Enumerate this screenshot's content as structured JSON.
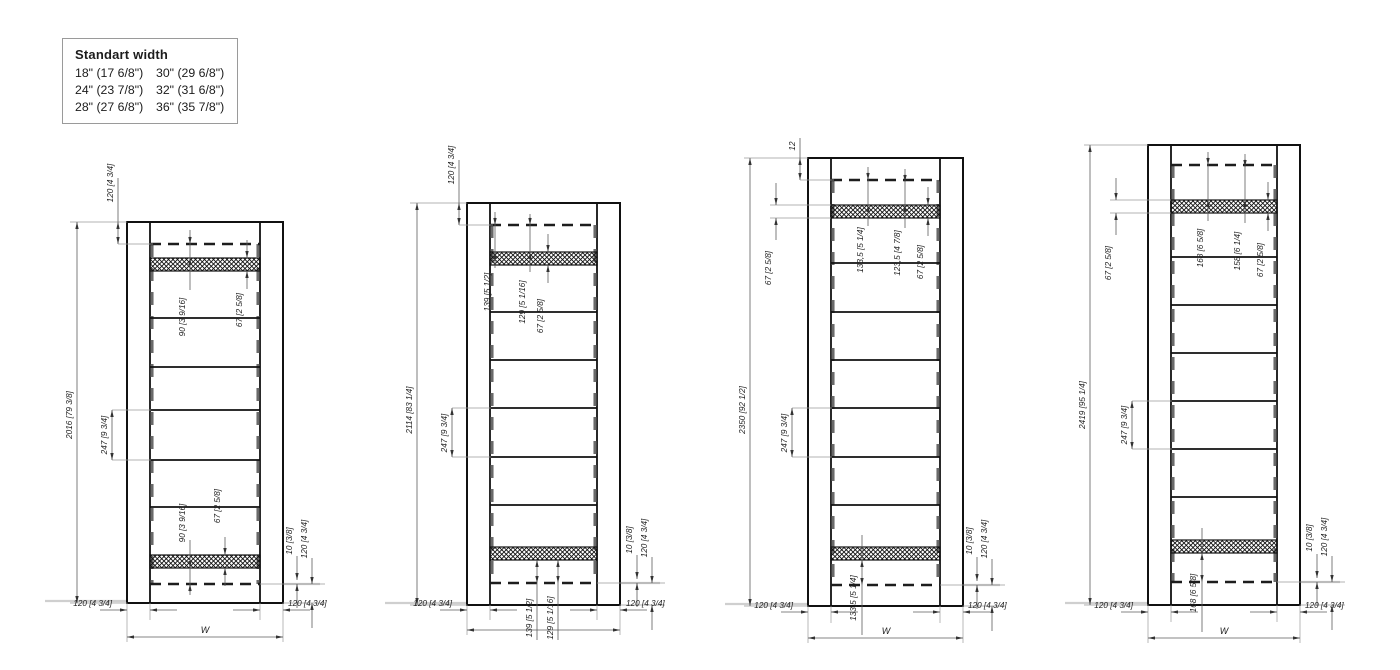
{
  "legend": {
    "title": "Standart width",
    "col1": [
      "18\" (17 6/8\")",
      "24\" (23 7/8\")",
      "28\" (27 6/8\")"
    ],
    "col2": [
      "30\" (29 6/8\")",
      "32\" (31 6/8\")",
      "36\" (35 7/8\")"
    ]
  },
  "doors": [
    {
      "height": "2016 [79 3/8]",
      "top": "120 [4 3/4]",
      "gap": "247 [9 3/4]",
      "it_a": "90 [3 9/16]",
      "it_c": "67 [2 5/8]",
      "ib_a": "90 [3 9/16]",
      "ib_c": "67 [2 5/8]",
      "r10": "10 [3/8]",
      "r120": "120 [4 3/4]",
      "bl": "120 [4 3/4]",
      "br": "120 [4 3/4]",
      "w": "W"
    },
    {
      "height": "2114 [83 1/4]",
      "top": "120 [4 3/4]",
      "gap": "247 [9 3/4]",
      "it_a": "139 [5 1/2]",
      "it_b": "129 [5 1/16]",
      "it_c": "67 [2 5/8]",
      "ib_a": "139 [5 1/2]",
      "ib_b": "129 [5 1/16]",
      "r10": "10 [3/8]",
      "r120": "120 [4 3/4]",
      "bl": "120 [4 3/4]",
      "br": "120 [4 3/4]"
    },
    {
      "height": "2350 [92 1/2]",
      "top": "12",
      "left67": "67 [2 5/8]",
      "gap": "247 [9 3/4]",
      "it_a": "133,5 [5 1/4]",
      "it_b": "123,5 [4 7/8]",
      "it_c": "67 [2 5/8]",
      "ib_a": "133,5 [5 1/4]",
      "r10": "10 [3/8]",
      "r120": "120 [4 3/4]",
      "bl": "120 [4 3/4]",
      "br": "120 [4 3/4]",
      "w": "W"
    },
    {
      "height": "2419 [95 1/4]",
      "left67": "67 [2 5/8]",
      "gap": "247 [9 3/4]",
      "it_a": "168 [6 5/8]",
      "it_b": "158 [6 1/4]",
      "it_c": "67 [2 5/8]",
      "ib_a": "168 [6 5/8]",
      "r10": "10 [3/8]",
      "r120": "120 [4 3/4]",
      "bl": "120 [4 3/4]",
      "br": "120 [4 3/4]",
      "w": "W"
    }
  ]
}
